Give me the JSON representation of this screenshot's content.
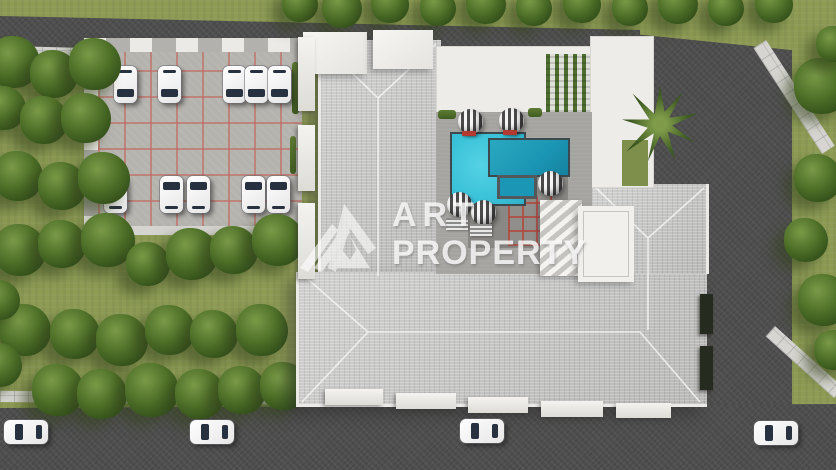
{
  "watermark": {
    "brand_line1": "ART",
    "brand_line2": "PROPERTY",
    "logo": "mountain-stripes-icon"
  },
  "scene": {
    "type": "aerial-architectural-render",
    "features": [
      "U-shaped residential building with gray hip tile roofs",
      "courtyard with L-shaped turquoise swimming pool and kids pool",
      "pool deck with striped parasols and loungers",
      "rooftop pergola with green vines",
      "tiled parking lot with two rows of white cars",
      "asphalt streets bordering the plot with parked white cars",
      "landscaped garden with grid of trees",
      "palm tree near east wing"
    ]
  },
  "colors": {
    "grass": "#8d9b55",
    "tree_foliage": "#41601f",
    "road_asphalt": "#4e4e4e",
    "sidewalk": "#d6d5d1",
    "roof_tiles": "#c7c7c5",
    "flat_roof": "#edece8",
    "pool_light": "#3cc3d9",
    "pool_dark": "#1b96b4",
    "parking_tile": "#b5b3ae",
    "parking_grout": "#c06a5f",
    "patio_grout_red": "#b0463c",
    "pergola_green": "#4e6e30",
    "car_body": "#f4f4f4",
    "lounger_red": "#b33a30"
  },
  "trees": {
    "left_garden": [
      [
        14,
        62,
        26
      ],
      [
        54,
        74,
        24
      ],
      [
        95,
        64,
        26
      ],
      [
        4,
        108,
        22
      ],
      [
        44,
        120,
        24
      ],
      [
        86,
        118,
        25
      ],
      [
        18,
        176,
        25
      ],
      [
        62,
        186,
        24
      ],
      [
        104,
        178,
        26
      ],
      [
        20,
        250,
        26
      ],
      [
        62,
        244,
        24
      ],
      [
        108,
        240,
        27
      ],
      [
        148,
        264,
        22
      ],
      [
        192,
        254,
        26
      ],
      [
        234,
        250,
        24
      ],
      [
        278,
        240,
        26
      ],
      [
        25,
        330,
        26
      ],
      [
        75,
        334,
        25
      ],
      [
        122,
        340,
        26
      ],
      [
        170,
        330,
        25
      ],
      [
        214,
        334,
        24
      ],
      [
        262,
        330,
        26
      ],
      [
        58,
        390,
        26
      ],
      [
        102,
        394,
        25
      ],
      [
        152,
        390,
        27
      ],
      [
        200,
        394,
        25
      ],
      [
        242,
        390,
        24
      ],
      [
        284,
        386,
        24
      ],
      [
        0,
        300,
        20
      ],
      [
        0,
        365,
        22
      ]
    ],
    "top_row": [
      [
        300,
        4,
        18
      ],
      [
        342,
        8,
        20
      ],
      [
        390,
        4,
        19
      ],
      [
        438,
        8,
        18
      ],
      [
        486,
        4,
        20
      ],
      [
        534,
        8,
        18
      ],
      [
        582,
        4,
        19
      ],
      [
        630,
        8,
        18
      ],
      [
        678,
        4,
        20
      ],
      [
        726,
        8,
        18
      ],
      [
        774,
        4,
        19
      ]
    ],
    "right_strip": [
      [
        822,
        86,
        28
      ],
      [
        834,
        44,
        18
      ],
      [
        818,
        178,
        24
      ],
      [
        806,
        240,
        22
      ],
      [
        824,
        300,
        26
      ],
      [
        834,
        350,
        20
      ]
    ]
  },
  "parking": {
    "car_count": 10,
    "rows": [
      {
        "y": 66,
        "nose": "nose-down",
        "car_x": [
          114,
          158,
          223,
          245,
          268
        ]
      },
      {
        "y": 176,
        "nose": "nose-up",
        "car_x": [
          104,
          160,
          187,
          242,
          267
        ]
      }
    ]
  },
  "street_cars": [
    [
      4,
      420
    ],
    [
      190,
      420
    ],
    [
      460,
      419
    ],
    [
      754,
      421
    ]
  ],
  "pool": {
    "main_light": [
      450,
      132,
      72,
      70
    ],
    "main_dark": [
      488,
      138,
      78,
      35
    ],
    "kids": [
      497,
      175,
      34,
      18
    ]
  },
  "umbrellas": [
    [
      458,
      109
    ],
    [
      499,
      108
    ],
    [
      538,
      171
    ],
    [
      447,
      192
    ],
    [
      471,
      200
    ]
  ],
  "loungers_red": [
    [
      462,
      131
    ],
    [
      503,
      130
    ]
  ],
  "loungers_gray": [
    [
      446,
      218
    ],
    [
      470,
      224
    ]
  ]
}
